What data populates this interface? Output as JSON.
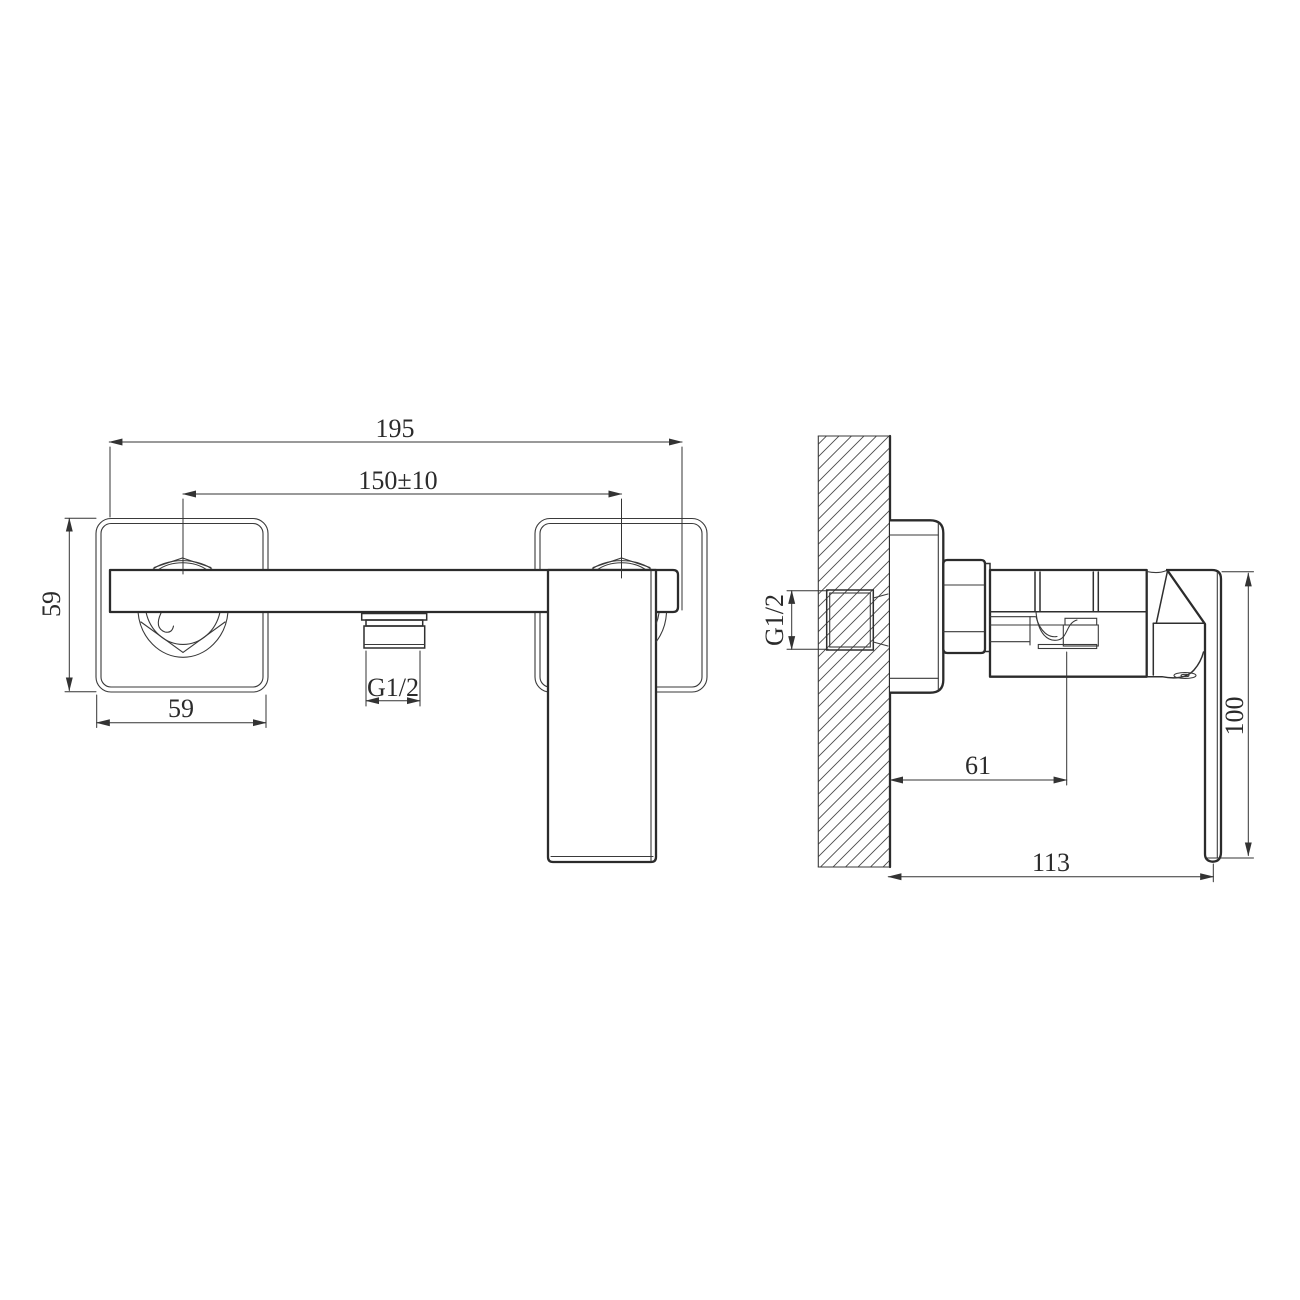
{
  "drawing": {
    "type": "technical-drawing",
    "views": {
      "left": "front view",
      "right": "side view"
    },
    "colors": {
      "line": "#2b2b2b",
      "background": "#ffffff",
      "hatch": "#4a4a4a"
    }
  },
  "front_view": {
    "dim_overall_width": "195",
    "dim_hole_centers": "150±10",
    "dim_plate_height": "59",
    "dim_plate_width": "59",
    "dim_outlet_thread": "G1/2"
  },
  "side_view": {
    "dim_inlet_thread": "G1/2",
    "dim_outlet_offset": "61",
    "dim_total_depth": "113",
    "dim_handle_height": "100"
  }
}
